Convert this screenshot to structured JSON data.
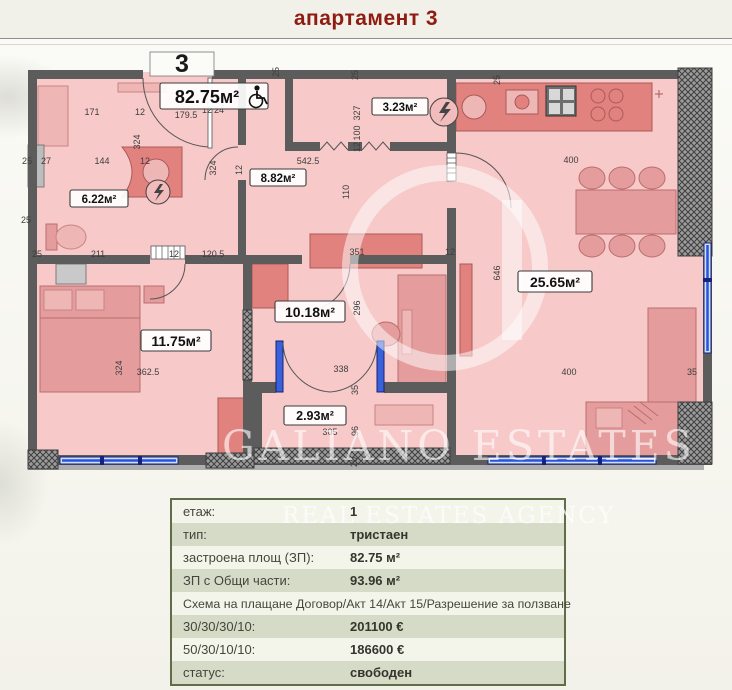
{
  "header": {
    "title": "апартамент 3"
  },
  "floor_plan": {
    "apartment_number": "3",
    "main_area_label": "82.75м²",
    "entrance_width": "179.5",
    "rooms": [
      {
        "name": "bathroom",
        "area": "6.22м²"
      },
      {
        "name": "storage",
        "area": "3.23м²"
      },
      {
        "name": "hallway",
        "area": "8.82м²"
      },
      {
        "name": "bedroom-left",
        "area": "11.75м²"
      },
      {
        "name": "bedroom-middle",
        "area": "10.18м²"
      },
      {
        "name": "balcony",
        "area": "2.93м²"
      },
      {
        "name": "living-room",
        "area": "25.65м²"
      }
    ],
    "dimensions": [
      {
        "text": "171",
        "x": 82,
        "y": 65
      },
      {
        "text": "12",
        "x": 130,
        "y": 65
      },
      {
        "text": "179.5",
        "x": 176,
        "y": 68
      },
      {
        "text": "12",
        "x": 197,
        "y": 63
      },
      {
        "text": "24",
        "x": 209,
        "y": 63
      },
      {
        "text": "25",
        "x": 17,
        "y": 114
      },
      {
        "text": "27",
        "x": 36,
        "y": 114
      },
      {
        "text": "144",
        "x": 92,
        "y": 114
      },
      {
        "text": "12",
        "x": 135,
        "y": 114
      },
      {
        "text": "542.5",
        "x": 298,
        "y": 114
      },
      {
        "text": "25",
        "x": 16,
        "y": 173
      },
      {
        "text": "211",
        "x": 88,
        "y": 207
      },
      {
        "text": "12",
        "x": 164,
        "y": 207
      },
      {
        "text": "120.5",
        "x": 203,
        "y": 207
      },
      {
        "text": "25",
        "x": 27,
        "y": 207
      },
      {
        "text": "362.5",
        "x": 138,
        "y": 325
      },
      {
        "text": "351",
        "x": 347,
        "y": 205
      },
      {
        "text": "12",
        "x": 440,
        "y": 205
      },
      {
        "text": "338",
        "x": 331,
        "y": 322
      },
      {
        "text": "305",
        "x": 320,
        "y": 385
      },
      {
        "text": "400",
        "x": 561,
        "y": 113
      },
      {
        "text": "400",
        "x": 559,
        "y": 325
      },
      {
        "text": "35",
        "x": 682,
        "y": 325
      },
      {
        "text": "25",
        "x": 269,
        "y": 22,
        "rot": true
      },
      {
        "text": "324",
        "x": 130,
        "y": 92,
        "rot": true
      },
      {
        "text": "324",
        "x": 206,
        "y": 118,
        "rot": true
      },
      {
        "text": "324",
        "x": 112,
        "y": 318,
        "rot": true
      },
      {
        "text": "327",
        "x": 350,
        "y": 63,
        "rot": true
      },
      {
        "text": "100",
        "x": 350,
        "y": 83,
        "rot": true
      },
      {
        "text": "12",
        "x": 350,
        "y": 97,
        "rot": true
      },
      {
        "text": "25",
        "x": 348,
        "y": 25,
        "rot": true
      },
      {
        "text": "110",
        "x": 339,
        "y": 142,
        "rot": true
      },
      {
        "text": "296",
        "x": 350,
        "y": 258,
        "rot": true
      },
      {
        "text": "35",
        "x": 348,
        "y": 340,
        "rot": true
      },
      {
        "text": "96",
        "x": 348,
        "y": 381,
        "rot": true
      },
      {
        "text": "20",
        "x": 347,
        "y": 412,
        "rot": true
      },
      {
        "text": "646",
        "x": 490,
        "y": 223,
        "rot": true
      },
      {
        "text": "25",
        "x": 490,
        "y": 30,
        "rot": true
      },
      {
        "text": "12",
        "x": 232,
        "y": 120,
        "rot": true
      }
    ],
    "watermark": {
      "brand": "GALIANO ESTATES",
      "tagline": "REAL ESTATES AGENCY"
    }
  },
  "details_table": {
    "rows": [
      {
        "label": "етаж:",
        "value": "1"
      },
      {
        "label": "тип:",
        "value": "тристаен"
      },
      {
        "label": "застроена площ (ЗП):",
        "value": "82.75 м²"
      },
      {
        "label": "ЗП с Общи части:",
        "value": "93.96 м²"
      },
      {
        "label": "Схема на плащане Договор/Акт 14/Акт 15/Разрешение за ползване",
        "value": ""
      },
      {
        "label": "30/30/30/10:",
        "value": "201100 €"
      },
      {
        "label": "50/30/10/10:",
        "value": "186600 €"
      },
      {
        "label": "статус:",
        "value": "свободен"
      }
    ]
  },
  "colors": {
    "title": "#8e1c10",
    "wall": "#5c5c5c",
    "room_fill": "#f7c9c9",
    "furniture": "#e59c9c",
    "window_blue": "#2753e0",
    "table_border": "#5f6e49",
    "table_row_alt": "#d6dbc8"
  }
}
